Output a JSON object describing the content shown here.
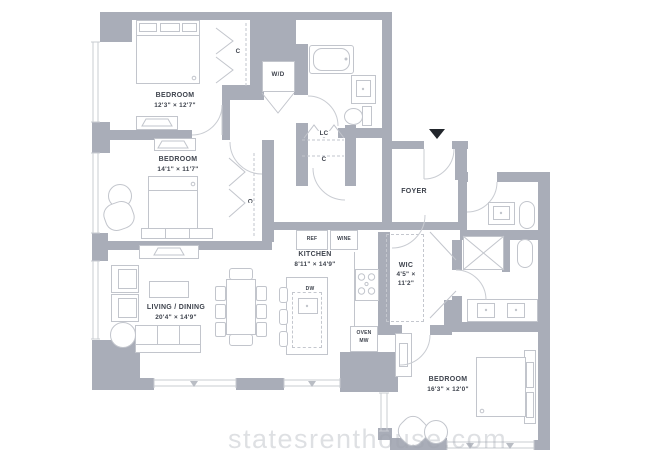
{
  "watermark": "statesrenthouse.com",
  "rooms": {
    "bedroom1": {
      "name": "BEDROOM",
      "dims": "12'3\" × 12'7\""
    },
    "bedroom2": {
      "name": "BEDROOM",
      "dims": "14'1\" × 11'7\""
    },
    "living": {
      "name": "LIVING / DINING",
      "dims": "20'4\" × 14'9\""
    },
    "kitchen": {
      "name": "KITCHEN",
      "dims": "8'11\" × 14'9\""
    },
    "wic": {
      "name": "WIC",
      "dims_line1": "4'5\" ×",
      "dims_line2": "11'2\""
    },
    "foyer": {
      "name": "FOYER"
    },
    "bedroom3": {
      "name": "BEDROOM",
      "dims": "16'3\" × 12'0\""
    }
  },
  "closets": {
    "bedroom1_closet": "C",
    "bedroom2_closet": "C",
    "hall_closet": "C",
    "linen_closet": "LC",
    "washer_dryer": "W/D"
  },
  "appliances": {
    "refrigerator": "REF",
    "wine_cooler": "WINE",
    "dishwasher": "DW",
    "oven": "OVEN",
    "microwave": "MW"
  },
  "colors": {
    "wall": "#a9adb8",
    "linework": "#c9ccd2",
    "text": "#3e434d",
    "entry_marker": "#22262c"
  }
}
